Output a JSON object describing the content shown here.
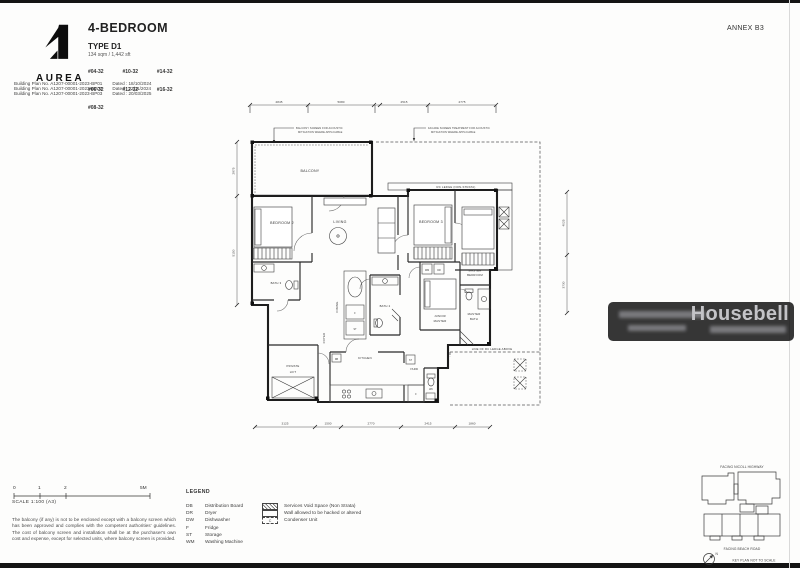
{
  "page": {
    "annex": "ANNEX B3"
  },
  "header": {
    "brand": "AUREA",
    "title": "4-BEDROOM",
    "type": "TYPE D1",
    "area": "134 sqm / 1,442 sft",
    "units": [
      "#04-32",
      "#10-32",
      "#14-32",
      "#06-32",
      "#12-32",
      "#16-32",
      "#08-32"
    ],
    "plans": [
      {
        "label": "Building Plan No. A1207-00001-2023-BP01",
        "dated": "Dated : 18/10/2024"
      },
      {
        "label": "Building Plan No. A1207-00001-2023-BP02",
        "dated": "Dated : 22/11/2024"
      },
      {
        "label": "Building Plan No. A1207-00001-2023-BP03",
        "dated": "Dated : 20/03/2025"
      }
    ]
  },
  "plan": {
    "callouts": {
      "left1": "BALCONY SCREEN FOR ACOUSTIC",
      "left2": "MITIGATION WHERE APPLICABLE",
      "right1": "FACADE SCREEN TREATMENT FOR ACOUSTIC",
      "right2": "MITIGATION WHERE APPLICABLE"
    },
    "labels": {
      "balcony": "BALCONY",
      "living": "LIVING",
      "dining": "DINING",
      "bedroom2": "BEDROOM 2",
      "bedroom3": "BEDROOM 3",
      "junior1": "JUNIOR",
      "junior2": "MASTER",
      "master1": "MASTER",
      "master2": "BEDROOM",
      "mbath1": "MASTER",
      "mbath2": "BATH",
      "bath2": "BATH 2",
      "bath3": "BATH 3",
      "lift1": "PRIVATE",
      "lift2": "LIFT",
      "foyer": "FOYER",
      "kitchen": "KITCHEN",
      "yard": "YARD",
      "wc": "WC",
      "db": "DB",
      "f": "F",
      "st": "ST",
      "wm": "WM",
      "dr": "DR",
      "rc_ledge": "RC LEDGE (NON-STRATA)",
      "ledge_above": "LINE OF RC LEDGE ABOVE"
    },
    "dims": {
      "top": [
        "2845",
        "5080",
        "2515",
        "2775"
      ],
      "bottom": [
        "3125",
        "1500",
        "2770",
        "2415",
        "1860"
      ],
      "left": [
        "2875",
        "5150"
      ],
      "right": [
        "4025",
        "3730"
      ]
    }
  },
  "watermark": {
    "brand": "Housebell"
  },
  "scalebar": {
    "t0": "0",
    "t1": "1",
    "t2": "2",
    "t5": "5M",
    "label": "SCALE 1:100 (A3)"
  },
  "disclaimer": "The balcony (if any) is not to be enclosed except with a balcony screen which has been approved and complies with the competent authorities' guidelines. The cost of balcony screen and installation shall be at the purchaser's own cost and expense, except for selected units, where balcony screen is provided.",
  "legend": {
    "title": "LEGEND",
    "abbrevs": [
      {
        "abbr": "DB",
        "label": "Distribution Board"
      },
      {
        "abbr": "DR",
        "label": "Dryer"
      },
      {
        "abbr": "DW",
        "label": "Dishwasher"
      },
      {
        "abbr": "F",
        "label": "Fridge"
      },
      {
        "abbr": "ST",
        "label": "Storage"
      },
      {
        "abbr": "WM",
        "label": "Washing Machine"
      }
    ],
    "symbols": [
      {
        "label": "Services Void Space (Non Strata)"
      },
      {
        "label": "Wall allowed to be hacked or altered"
      },
      {
        "abbr": "C",
        "label": "Condenser Unit"
      }
    ]
  },
  "keyplan": {
    "top": "FACING NICOLL HIGHWAY",
    "bottom": "FACING BEACH ROAD",
    "note": "KEY PLAN NOT TO SCALE",
    "north": "N"
  }
}
